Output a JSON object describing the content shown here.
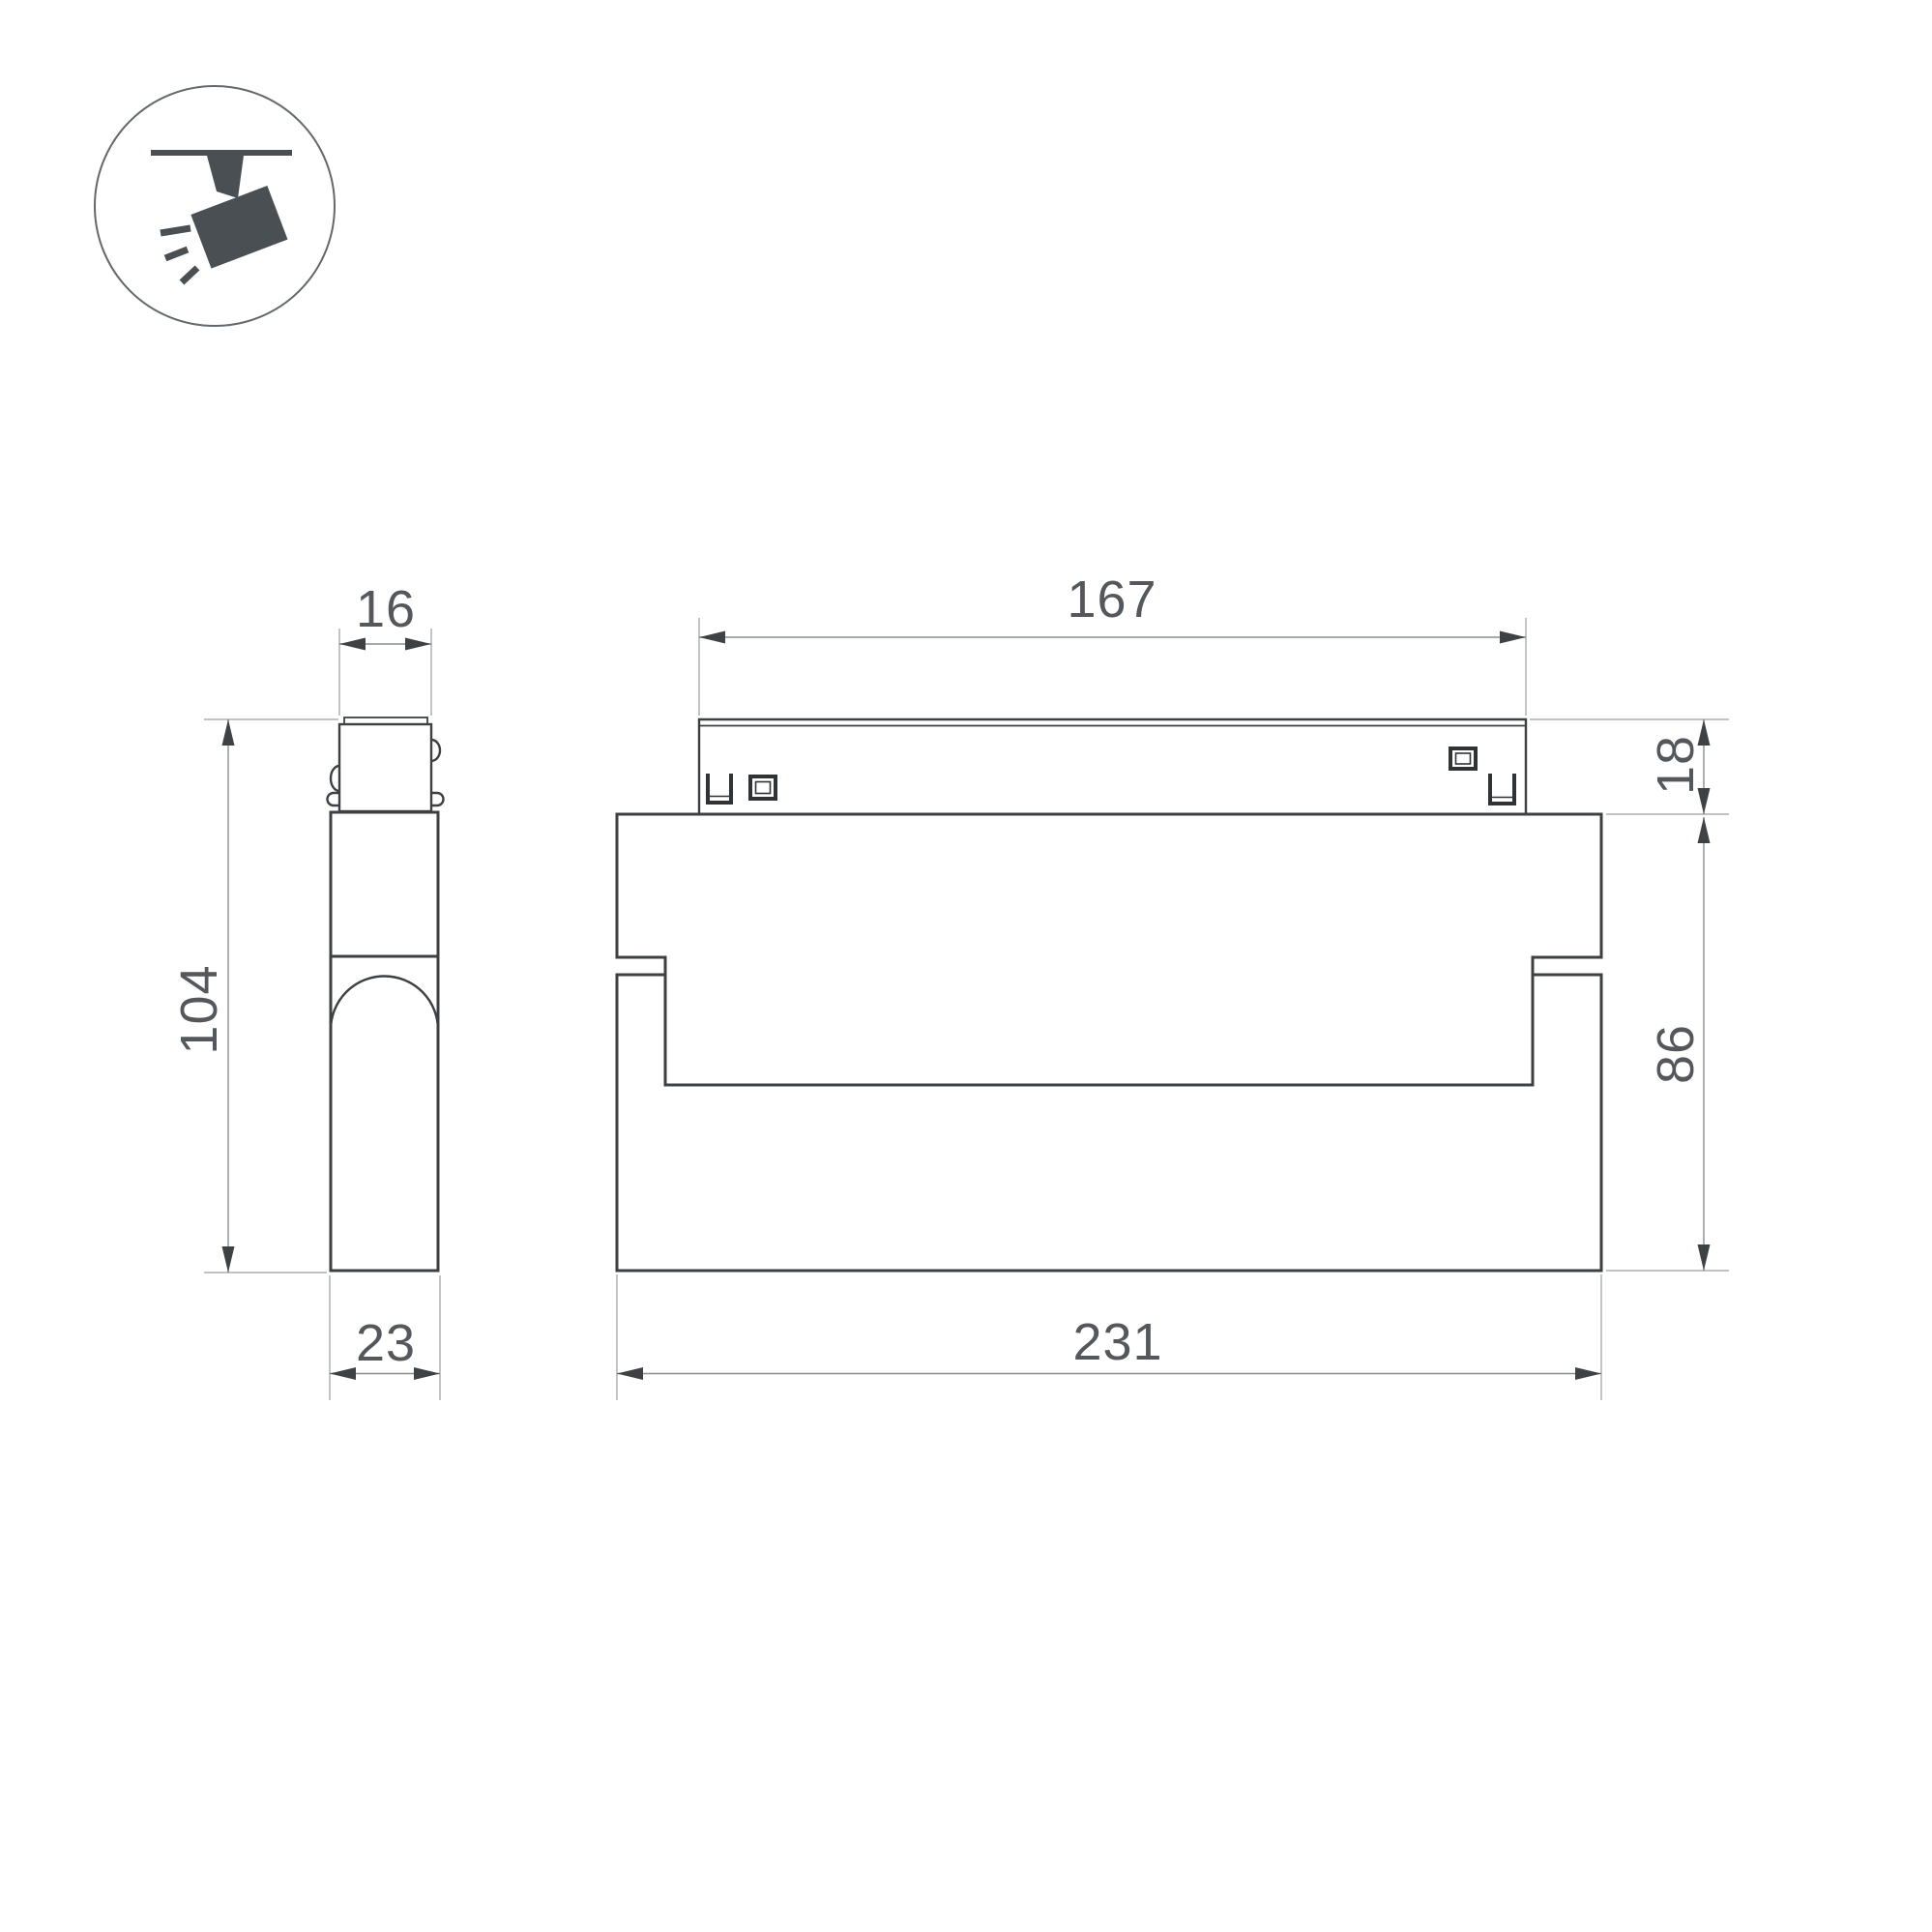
{
  "title": "Track luminaire dimensional drawing",
  "colors": {
    "background": "#ffffff",
    "object_line": "#3d4043",
    "dimension_line": "#8a8d90",
    "arrow": "#3f4245",
    "text": "#54575b",
    "icon": "#4a4f54"
  },
  "icon": {
    "name": "track-spotlight"
  },
  "views": {
    "side_view": "side profile",
    "front_view": "front elevation"
  },
  "dims": {
    "w16": "16",
    "h104": "104",
    "w23": "23",
    "w167": "167",
    "h18": "18",
    "h86": "86",
    "w231": "231"
  }
}
